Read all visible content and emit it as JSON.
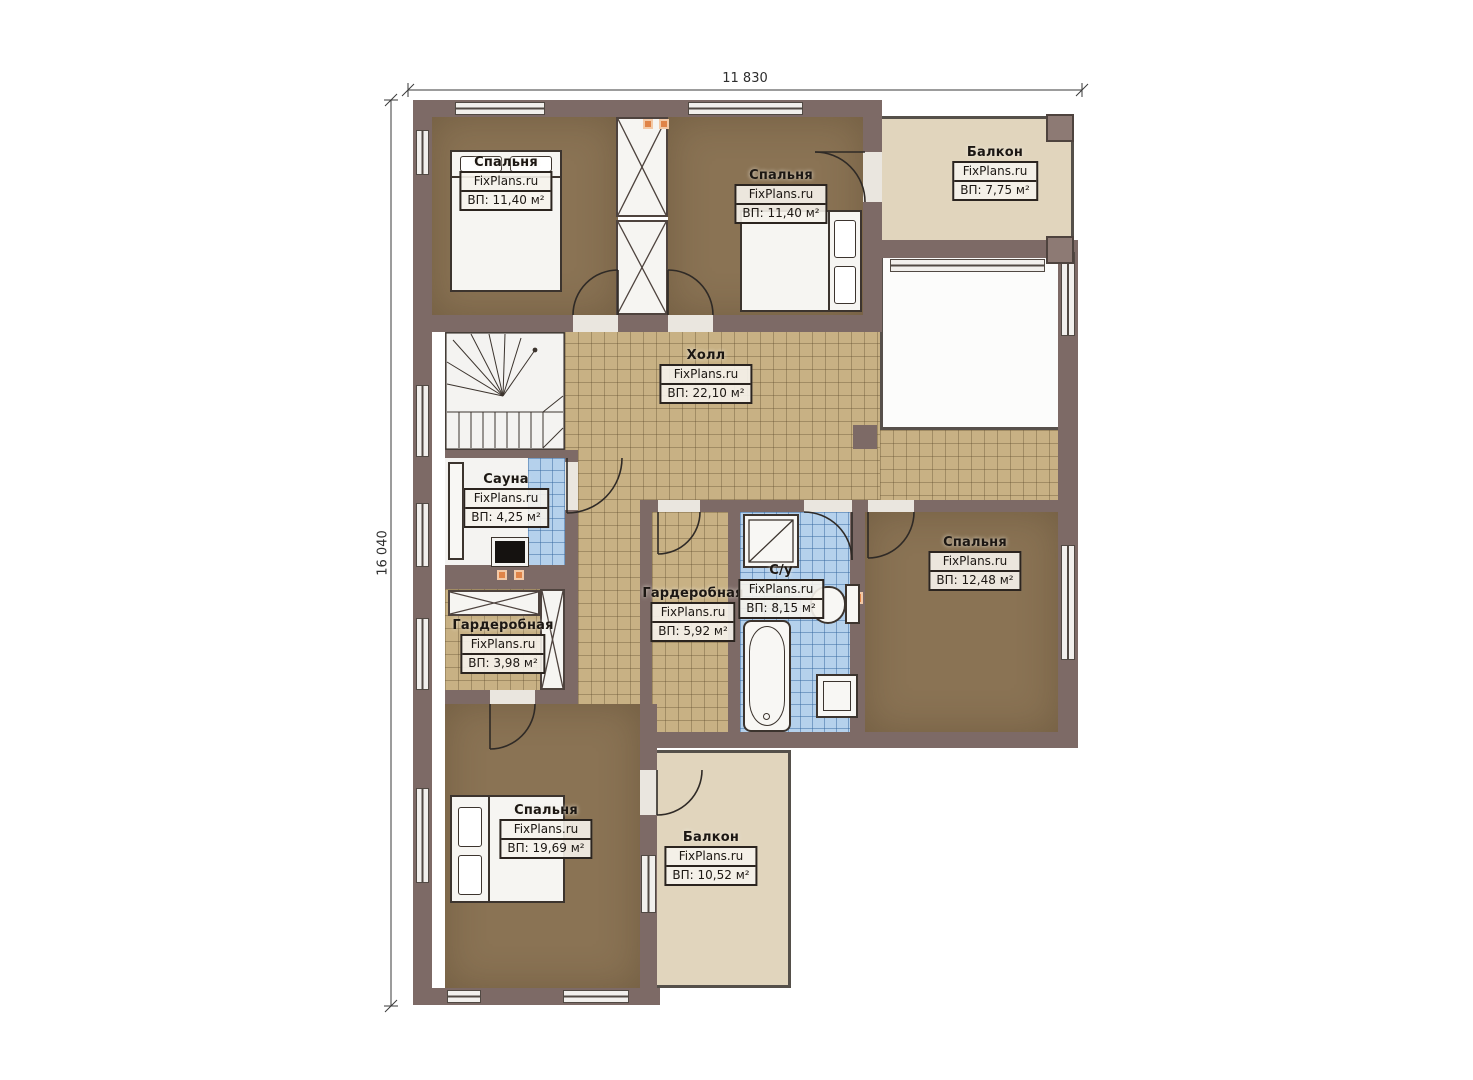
{
  "plan": {
    "title": "floor-plan",
    "watermark": "FixPlans.ru",
    "dimensions": {
      "width_label": "11 830",
      "height_label": "16 040"
    },
    "rooms": [
      {
        "id": "bedroom-top-left",
        "name": "Спальня",
        "area": "ВП: 11,40 м²"
      },
      {
        "id": "bedroom-top-middle",
        "name": "Спальня",
        "area": "ВП: 11,40 м²"
      },
      {
        "id": "balcony-top-right",
        "name": "Балкон",
        "area": "ВП: 7,75 м²"
      },
      {
        "id": "hall",
        "name": "Холл",
        "area": "ВП: 22,10 м²"
      },
      {
        "id": "sauna",
        "name": "Сауна",
        "area": "ВП: 4,25 м²"
      },
      {
        "id": "wardrobe-left",
        "name": "Гардеробная",
        "area": "ВП: 3,98 м²"
      },
      {
        "id": "wardrobe-middle",
        "name": "Гардеробная",
        "area": "ВП: 5,92 м²"
      },
      {
        "id": "bathroom",
        "name": "С/у",
        "area": "ВП: 8,15 м²"
      },
      {
        "id": "bedroom-right",
        "name": "Спальня",
        "area": "ВП: 12,48 м²"
      },
      {
        "id": "bedroom-bottom-left",
        "name": "Спальня",
        "area": "ВП: 19,69 м²"
      },
      {
        "id": "balcony-bottom",
        "name": "Балкон",
        "area": "ВП: 10,52 м²"
      }
    ],
    "colors": {
      "wall": "#7d6a66",
      "carpet": "#8a7354",
      "hall_tile": "#c8b184",
      "bath_tile": "#b5d1ec",
      "balcony": "#e1d5bd",
      "vent_accent": "#e08448"
    }
  }
}
